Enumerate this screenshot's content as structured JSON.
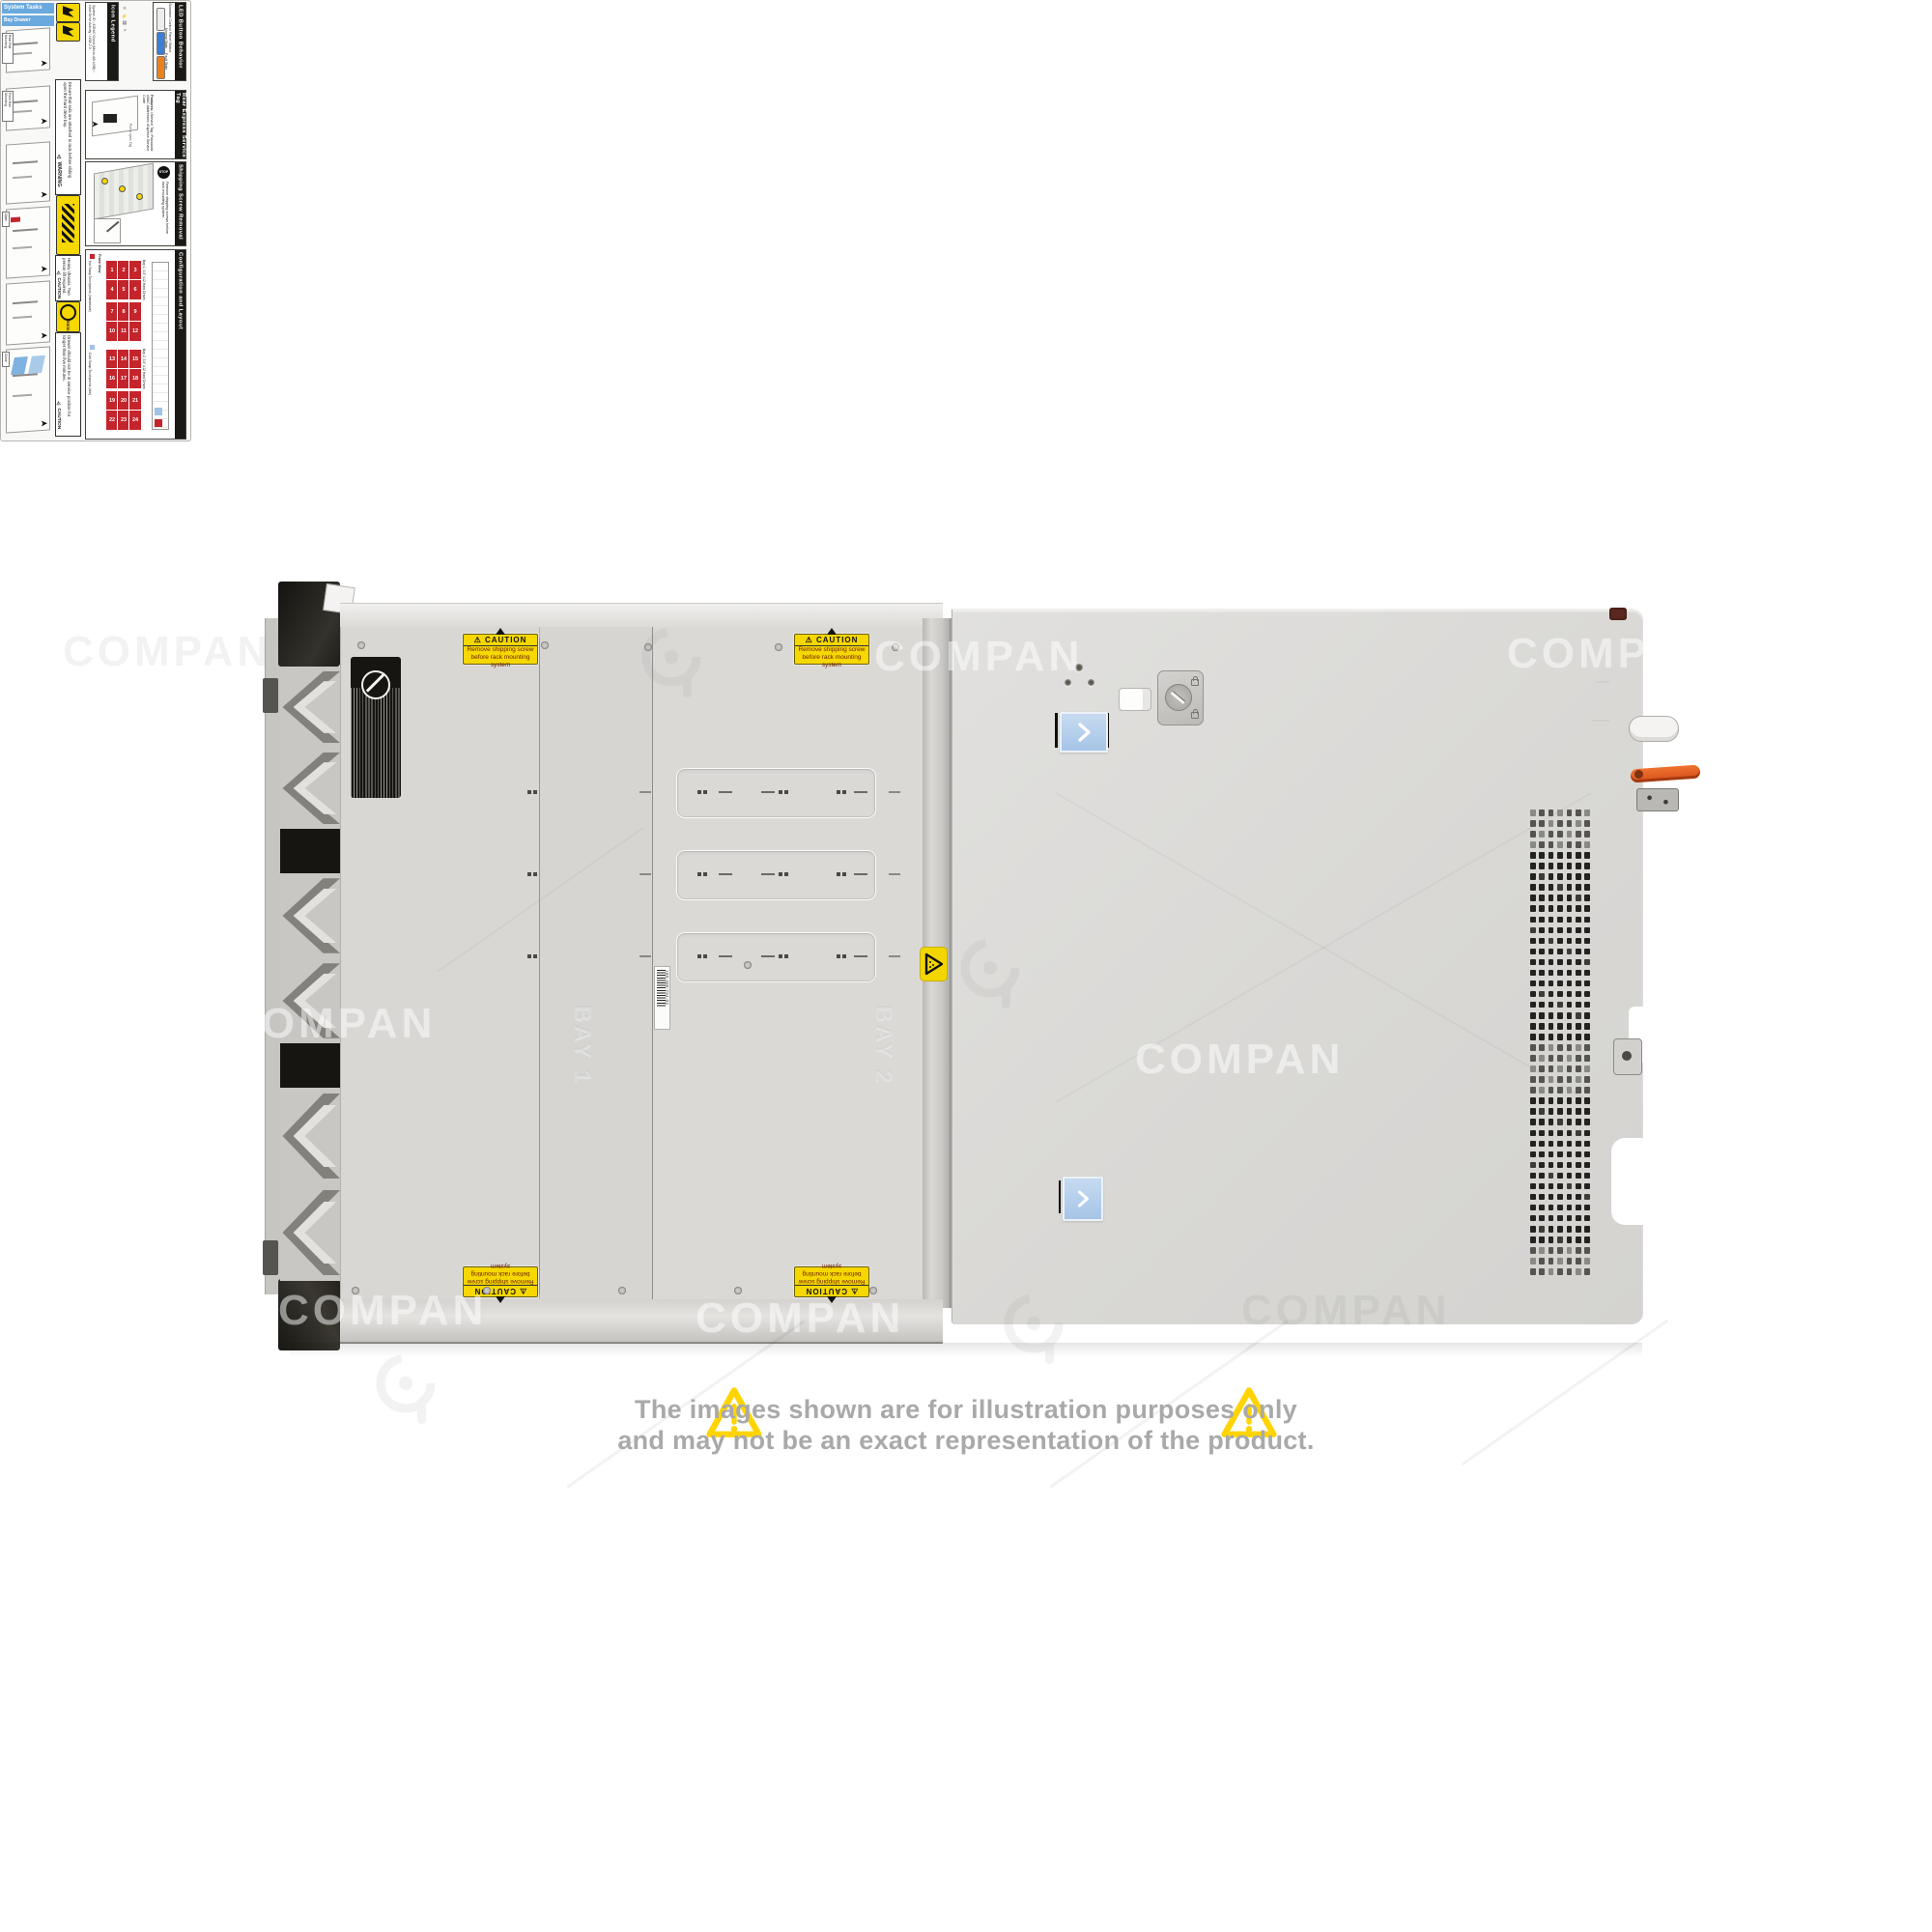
{
  "watermark": {
    "text": "COMPAN"
  },
  "disclaimer": {
    "line1": "The images shown are for illustration purposes only",
    "line2": "and may not be an exact representation of the product.",
    "warning_color": "#FFD400",
    "text_color": "#a9a9a9"
  },
  "chassis": {
    "caution_label": {
      "title": "⚠ CAUTION",
      "line1": "Remove shipping screw",
      "line2": "before rack mounting system"
    },
    "pinch_label": {
      "icon": "pinch-point-triangle-icon"
    },
    "regulatory_label": {
      "icon": "restriction-circle-icon"
    },
    "barcode_label": {
      "number": "100-400-294-03"
    },
    "emboss": {
      "bay1": "BAY 1",
      "bay2": "BAY 2"
    },
    "service_label": {
      "banners": {
        "b1": "System Tasks",
        "b2": "Bay Drawer Operation"
      },
      "steps": {
        "s1": "Rear Rail Mounting",
        "s2": "Front Rail Mounting",
        "s3": "Open",
        "s4": "Close"
      },
      "warning": {
        "title": "⚠ WARNING",
        "text": "Ensure that rails are attached to rack before sliding open the hard drive bay."
      },
      "caution_heavy": {
        "title": "⚠ CAUTION",
        "text": "Heavy chassis. Two person lift required."
      },
      "caution_drawer": {
        "title": "⚠ CAUTION",
        "badge": "5min",
        "text": "Drawer should not be in service position for longer than five minutes."
      },
      "icon_legend": {
        "title": "Icon Legend",
        "items": [
          "System ID",
          "iDRAC Direct (Micro-AB USB)",
          "Hard Drive Activity",
          "USB 2.0"
        ]
      },
      "led": {
        "title": "LED Button Behavior",
        "subtitle": "Standard Control Panel Status",
        "normal": "Normal State",
        "fault": "Fault State"
      },
      "rear_tag": {
        "title": "Rear Express Service Tag",
        "features_label": "Features:",
        "f1": "Service Tag",
        "f2": "Password",
        "f3": "MAC Addresses",
        "f4": "Express Service Code",
        "pull": "Pull to open Tag"
      },
      "shipping": {
        "title": "Shipping Screw Removal",
        "stop": "STOP",
        "text": "Remove shipping screws before rack mounting system."
      },
      "config": {
        "title": "Configuration and Layout",
        "legend_hot": "Hot Swap Touchpoints (Immediate)",
        "legend_cold": "Cold Swap Touchpoints (Idle)",
        "front_view": "Front View",
        "bay1": "Bay 1: 3.5\" x12 Hard Drives",
        "bay2": "Bay 2: 3.5\" x12 Hard Drives",
        "bay1_numbers": [
          [
            1,
            2,
            3
          ],
          [
            4,
            5,
            6
          ],
          [
            7,
            8,
            9
          ],
          [
            10,
            11,
            12
          ]
        ],
        "bay2_numbers": [
          [
            13,
            14,
            15
          ],
          [
            16,
            17,
            18
          ],
          [
            19,
            20,
            21
          ],
          [
            22,
            23,
            24
          ]
        ]
      }
    },
    "colors": {
      "panel": "#d9d8d5",
      "cover": "#dddcda",
      "label_yellow": "#f6d700",
      "touchpoint_blue": "#aac8ea",
      "lever_orange": "#e0571c",
      "table_red": "#c4242b"
    }
  }
}
